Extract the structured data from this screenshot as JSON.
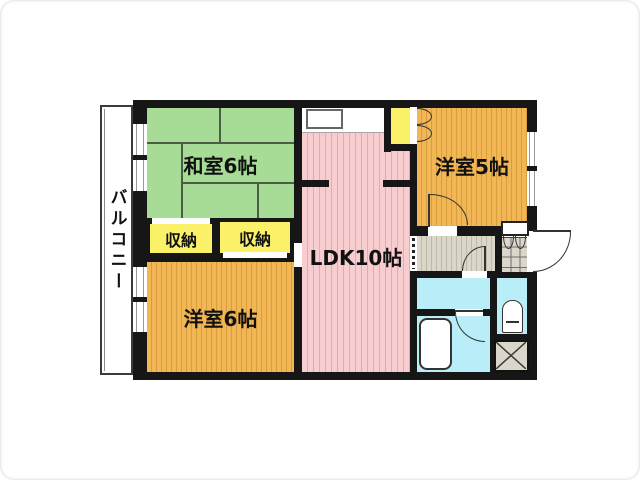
{
  "balcony": {
    "label": "バルコニー"
  },
  "rooms": {
    "washitsu": {
      "label": "和室6帖",
      "size_tatami": 6,
      "floor_color": "#A6DC95"
    },
    "storage_left": {
      "label": "収納",
      "floor_color": "#FBF169"
    },
    "storage_right": {
      "label": "収納",
      "floor_color": "#FBF169"
    },
    "youshitsu6": {
      "label": "洋室6帖",
      "size_tatami": 6,
      "floor_color": "#F2B654"
    },
    "ldk": {
      "label": "LDK10帖",
      "size_tatami": 10,
      "floor_color": "#F8CDD0"
    },
    "youshitsu5": {
      "label": "洋室5帖",
      "size_tatami": 5,
      "floor_color": "#F2B654"
    }
  },
  "colors": {
    "wall": "#161616",
    "wet_area_cyan": "#B9EEF8",
    "hallway_gray": "#DAD6CA",
    "storage_yellow": "#FBF169"
  }
}
